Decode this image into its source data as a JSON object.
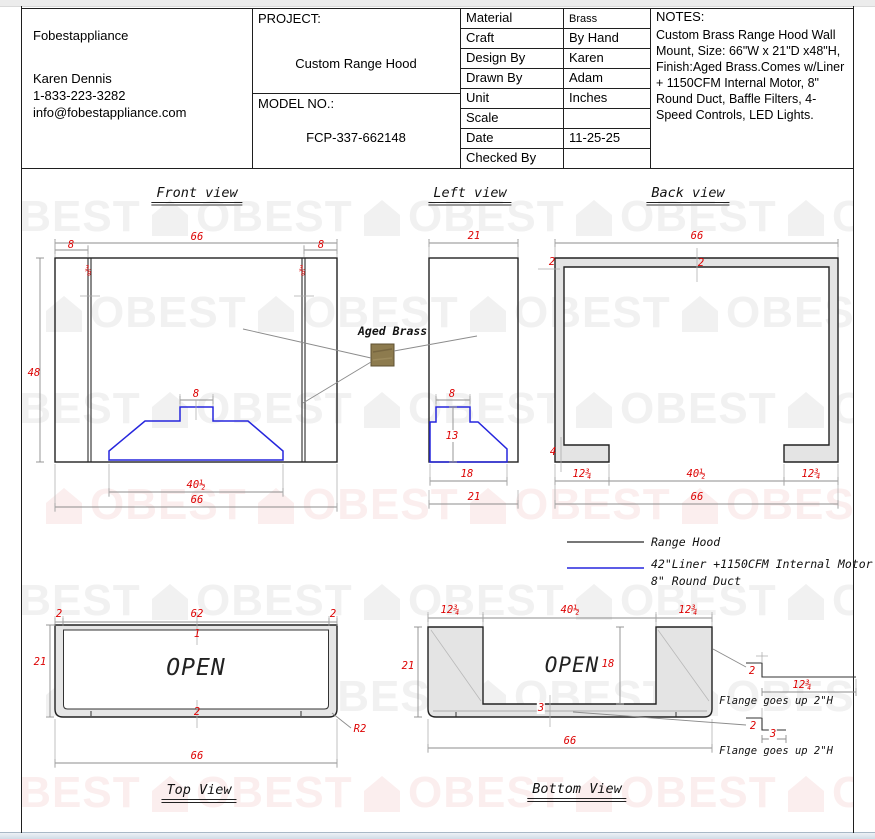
{
  "title_block": {
    "company": {
      "name": "Fobestappliance",
      "contact": "Karen Dennis",
      "phone": "1-833-223-3282",
      "email": "info@fobestappliance.com"
    },
    "project": {
      "label": "PROJECT:",
      "value": "Custom Range Hood"
    },
    "model": {
      "label": "MODEL NO.:",
      "value": "FCP-337-662148"
    },
    "fields": [
      {
        "label": "Material",
        "value": "Brass"
      },
      {
        "label": "Craft",
        "value": "By Hand"
      },
      {
        "label": "Design By",
        "value": "Karen"
      },
      {
        "label": "Drawn By",
        "value": "Adam"
      },
      {
        "label": "Unit",
        "value": "Inches"
      },
      {
        "label": "Scale",
        "value": ""
      },
      {
        "label": "Date",
        "value": "11-25-25"
      },
      {
        "label": "Checked By",
        "value": ""
      }
    ],
    "notes": {
      "label": "NOTES:",
      "text": "Custom Brass Range Hood Wall Mount, Size: 66\"W x 21\"D x48\"H, Finish:Aged Brass.Comes w/Liner + 1150CFM Internal Motor, 8\" Round Duct, Baffle Filters, 4-Speed Controls, LED Lights."
    }
  },
  "views": {
    "front": {
      "title": "Front view",
      "dims": {
        "total_width": "66",
        "left_offset": "8",
        "right_offset": "8",
        "left_wall": "⅜",
        "right_wall": "⅜",
        "height": "48",
        "duct_width": "8",
        "liner_width": "40½",
        "bottom_width": "66"
      }
    },
    "left": {
      "title": "Left view",
      "dims": {
        "depth": "21",
        "duct_width": "8",
        "liner_height": "13",
        "liner_depth": "18",
        "bottom_depth": "21"
      }
    },
    "back": {
      "title": "Back view",
      "dims": {
        "total_width": "66",
        "side_wall": "2",
        "top_wall": "2",
        "foot_height": "4",
        "left_foot": "12¾",
        "opening": "40½",
        "right_foot": "12¾",
        "bottom_width": "66"
      }
    },
    "top": {
      "title": "Top View",
      "open_label": "OPEN",
      "dims": {
        "left_wall": "2",
        "inner_width": "62",
        "right_wall": "2",
        "depth": "21",
        "front_edge": "1",
        "back_edge": "2",
        "total_width": "66",
        "corner_radius": "R2"
      }
    },
    "bottom": {
      "title": "Bottom View",
      "open_label": "OPEN",
      "dims": {
        "left_foot": "12¾",
        "opening": "40½",
        "right_foot": "12¾",
        "depth": "21",
        "inner_depth": "18",
        "back_wall": "3",
        "total_width": "66"
      },
      "flange_detail_upper": {
        "height": "2",
        "width": "12¾",
        "note": "Flange goes up 2\"H"
      },
      "flange_detail_lower": {
        "height": "2",
        "width": "3",
        "note": "Flange goes up 2\"H"
      }
    }
  },
  "legend": {
    "range_hood": "Range Hood",
    "liner_line1": "42\"Liner +1150CFM Internal Motor",
    "liner_line2": "8\" Round Duct"
  },
  "material_callout": {
    "label": "Aged Brass",
    "swatch_color": "#8d7b4e"
  },
  "watermark": {
    "text": "OBEST"
  },
  "colors": {
    "dimension_red": "#dd0404",
    "liner_blue": "#2626dd",
    "panel_gray": "#e4e4e4"
  }
}
